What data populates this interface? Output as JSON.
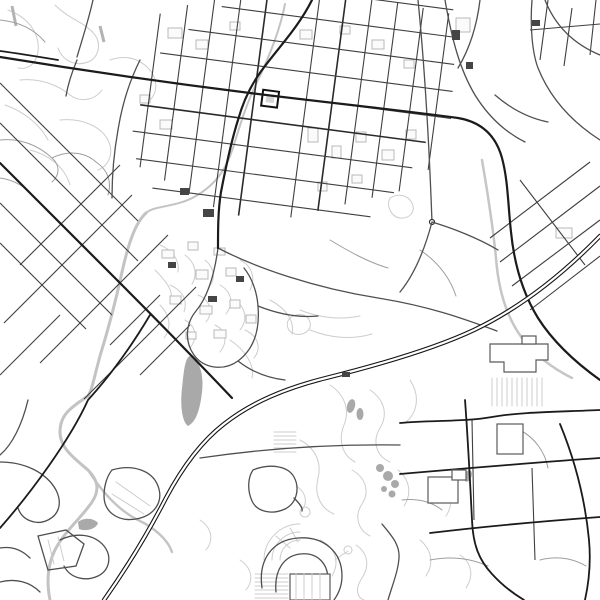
{
  "canvas": {
    "label": "monochrome-city-street-map",
    "width": 600,
    "height": 600
  },
  "colors": {
    "background": "#ffffff",
    "road_path": "#cdcdcd",
    "road_minor": "#9e9e9e",
    "road_grid": "#3f3f3f",
    "road_secondary": "#4f4f4f",
    "road_major": "#1b1b1b",
    "railway": "#141414",
    "river": "#c3c3c3",
    "water_fill": "#a9a9a9",
    "building_light": "#b8b8b8",
    "building_box": "#5a5a5a",
    "building_dark": "#454545",
    "plaza_fill": "#d6d6d6"
  },
  "features": [
    {
      "name": "downtown-street-grid",
      "color_ref": "road_grid"
    },
    {
      "name": "central-plaza-square",
      "color_ref": "plaza_fill"
    },
    {
      "name": "main-artery-road",
      "color_ref": "road_major"
    },
    {
      "name": "diagonal-avenue",
      "color_ref": "road_major"
    },
    {
      "name": "diagonal-neighborhood-grid",
      "color_ref": "road_grid"
    },
    {
      "name": "railway-highway-double-line",
      "color_ref": "railway"
    },
    {
      "name": "river-stream",
      "color_ref": "river"
    },
    {
      "name": "pond",
      "color_ref": "water_fill"
    },
    {
      "name": "campus-path-network",
      "color_ref": "road_path"
    },
    {
      "name": "big-box-buildings-with-parking-rows",
      "color_ref": "building_box"
    },
    {
      "name": "amphitheater-horseshoe",
      "color_ref": "road_secondary"
    },
    {
      "name": "suburban-cul-de-sac-loops",
      "color_ref": "road_path"
    }
  ]
}
